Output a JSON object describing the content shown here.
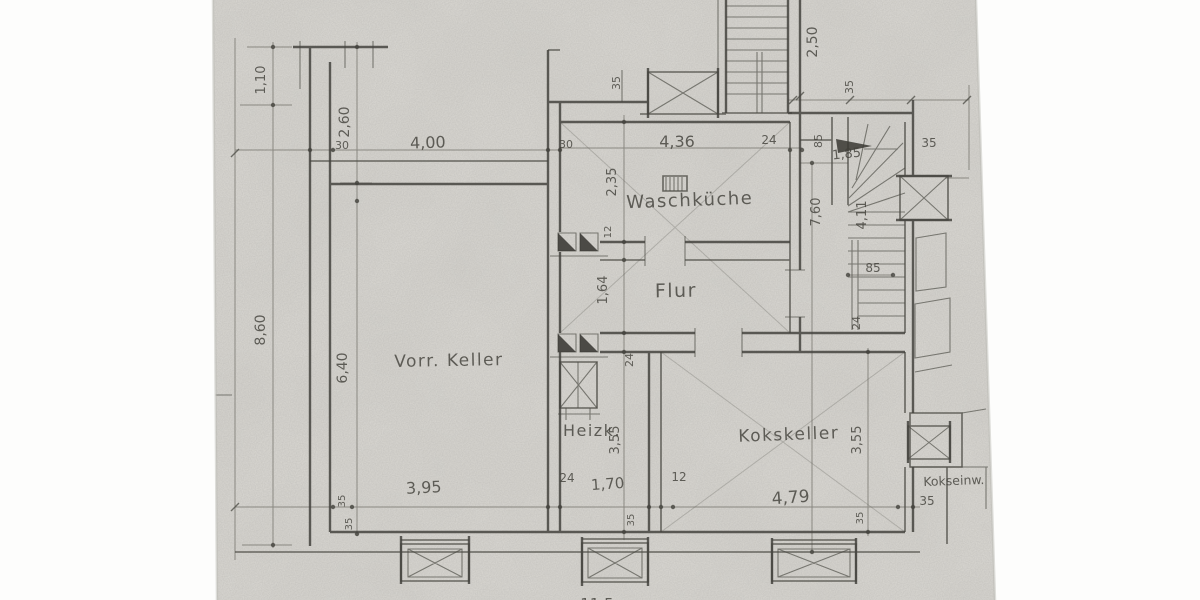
{
  "document": {
    "kind": "scanned hand-drawn basement floor plan, pencil on paper",
    "language": "German"
  },
  "palette": {
    "paper": "#d7d5d0",
    "pencil": "#45443e",
    "scan_margin": "#fdfdfc"
  },
  "labels": {
    "rooms": {
      "waschkueche": "Waschküche",
      "flur": "Flur",
      "vorr_keller": "Vorr. Keller",
      "heizk": "Heizk.",
      "kokskeller": "Kokskeller",
      "kokseinw": "Kokseinw."
    },
    "dims": {
      "v1_10": "1,10",
      "v2_60": "2,60",
      "v8_60": "8,60",
      "v6_40": "6,40",
      "v2_50": "2,50",
      "v2_35": "2,35",
      "v1_64": "1,64",
      "v7_60": "7,60",
      "v4_11": "4,11",
      "v3_55": "3,55",
      "h4_00": "4,00",
      "h4_36": "4,36",
      "h1_85": "1,85",
      "h3_95": "3,95",
      "h1_70": "1,70",
      "h4_79": "4,79",
      "n30": "30",
      "n35": "35",
      "n24": "24",
      "n12": "12",
      "n85": "85",
      "partial11_5": "11,5"
    }
  },
  "icons": {
    "window": "crossed-box-window-icon",
    "door": "filled-triangle-door-icon",
    "stair_interior": "winding-stair-icon",
    "stair_exterior": "straight-stair-icon",
    "flue": "boxed-asterisk-flue-icon",
    "drain": "hatched-drain-icon"
  }
}
